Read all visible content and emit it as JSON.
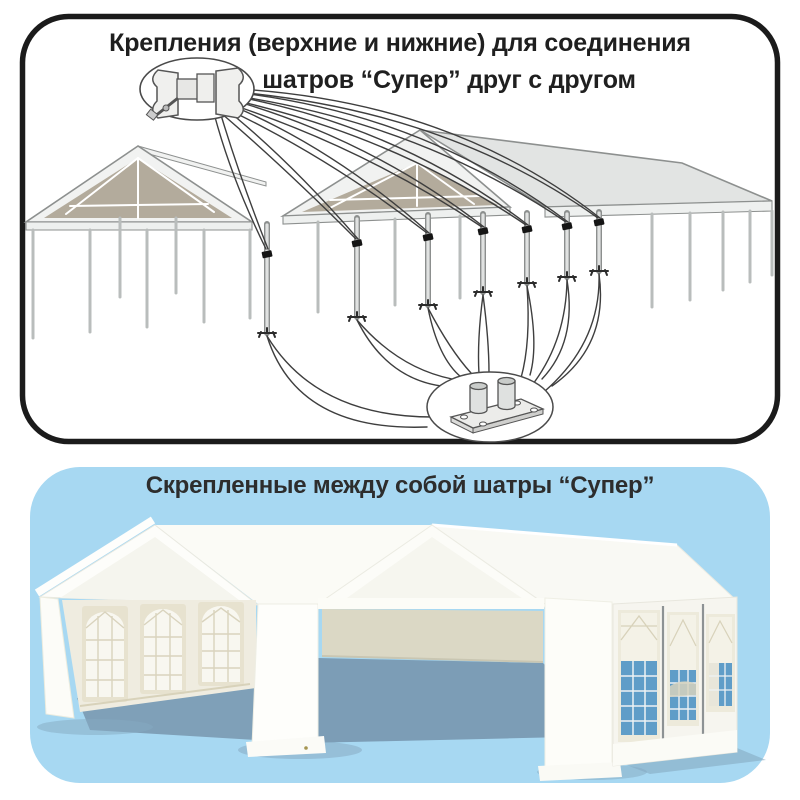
{
  "upper_panel": {
    "title_line1": "Крепления (верхние и нижние) для соединения",
    "title_line2": "шатров “Супер” друг с другом",
    "top_callout_icon": "pipe-clamp-icon",
    "bottom_callout_icon": "base-plate-icon",
    "clamp_points_count": 7
  },
  "lower_panel": {
    "title": "Скрепленные между собой шатры “Супер”"
  },
  "colors": {
    "panel_border": "#1b1b1b",
    "title_text": "#1f1f1f",
    "card_background": "#a7d8f2",
    "roof_underside_tan": "#b3ab9c",
    "frame_light_gray": "#e2e4e3",
    "window_glass_blue": "#5f9dc8",
    "interior_wall_beige": "#dbd8c5",
    "floor_shadow_blue": "#7e9eb6"
  }
}
